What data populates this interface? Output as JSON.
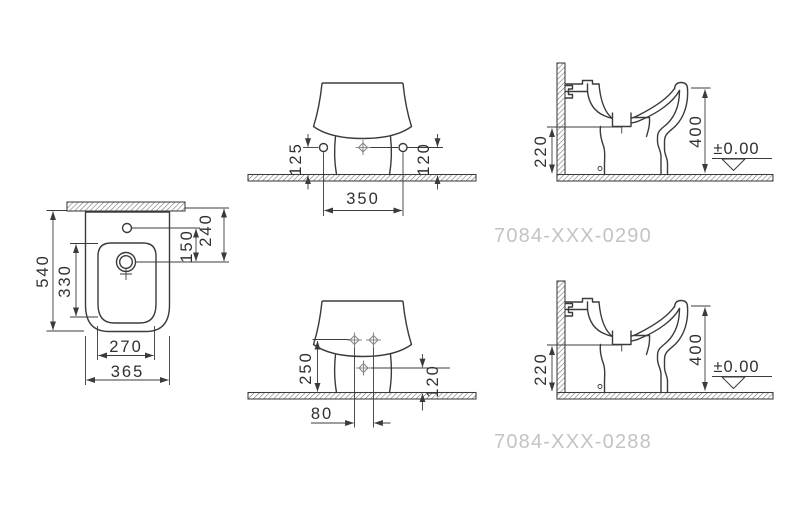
{
  "drawing_type": "bidet installation technical drawing",
  "views": {
    "plan": {
      "overall_length": "540",
      "bowl_length": "330",
      "tap_to_drain": "150",
      "wall_to_drain": "240",
      "bowl_width": "270",
      "overall_width": "365"
    },
    "front_0290": {
      "left_hole_height": "125",
      "right_hole_height": "120",
      "hole_spacing": "350"
    },
    "side_0290": {
      "drain_height": "220",
      "rim_height": "400",
      "floor_datum": "±0.00",
      "part_number": "7084-XXX-0290"
    },
    "front_0288": {
      "fixing_height": "250",
      "drain_height": "120",
      "fixing_spacing": "80"
    },
    "side_0288": {
      "drain_height": "220",
      "rim_height": "400",
      "floor_datum": "±0.00",
      "part_number": "7084-XXX-0288"
    }
  },
  "colors": {
    "line": "#3b3b3b",
    "dimension_text": "#303030",
    "part_number_gray": "#c3c3c3",
    "center_mark_gray": "#8a8a8a",
    "background": "#ffffff"
  }
}
